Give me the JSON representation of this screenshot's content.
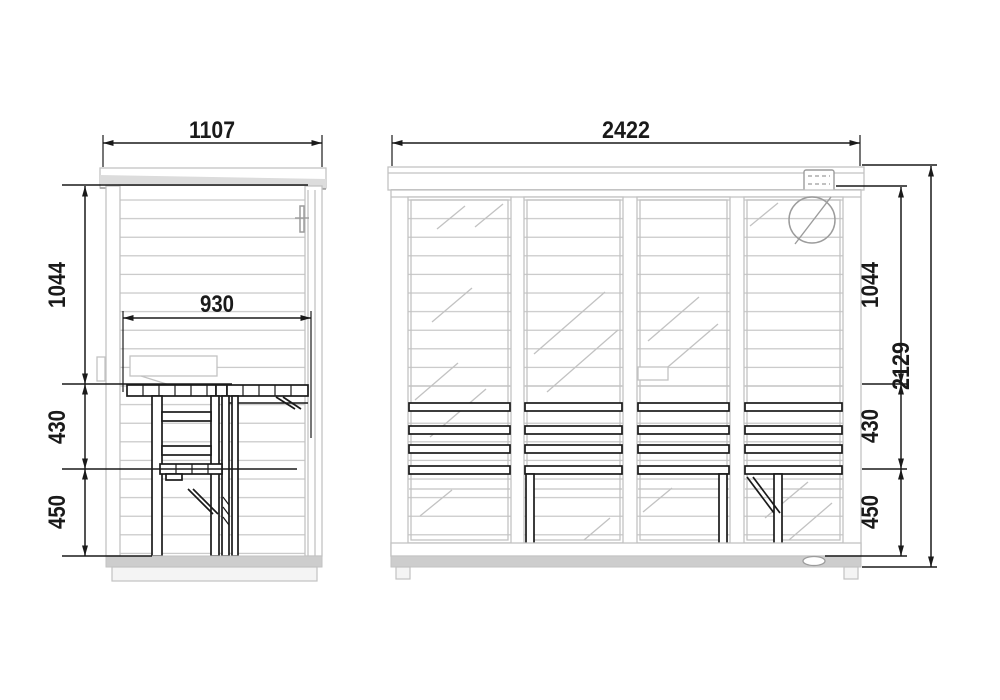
{
  "colors": {
    "dark": "#1a1a1a",
    "light": "#c2c2c2",
    "mid": "#9c9c9c",
    "roof": "#dcdcdc",
    "base": "#cdcdcd"
  },
  "views": {
    "side": {
      "dims": {
        "width": "1107",
        "interior_width": "930",
        "wall_upper": "1044",
        "bench_mid": "430",
        "bench_lower": "450"
      }
    },
    "front": {
      "dims": {
        "width": "2422",
        "wall_upper": "1044",
        "bench_mid": "430",
        "bench_lower": "450",
        "total_height": "2129"
      }
    }
  }
}
